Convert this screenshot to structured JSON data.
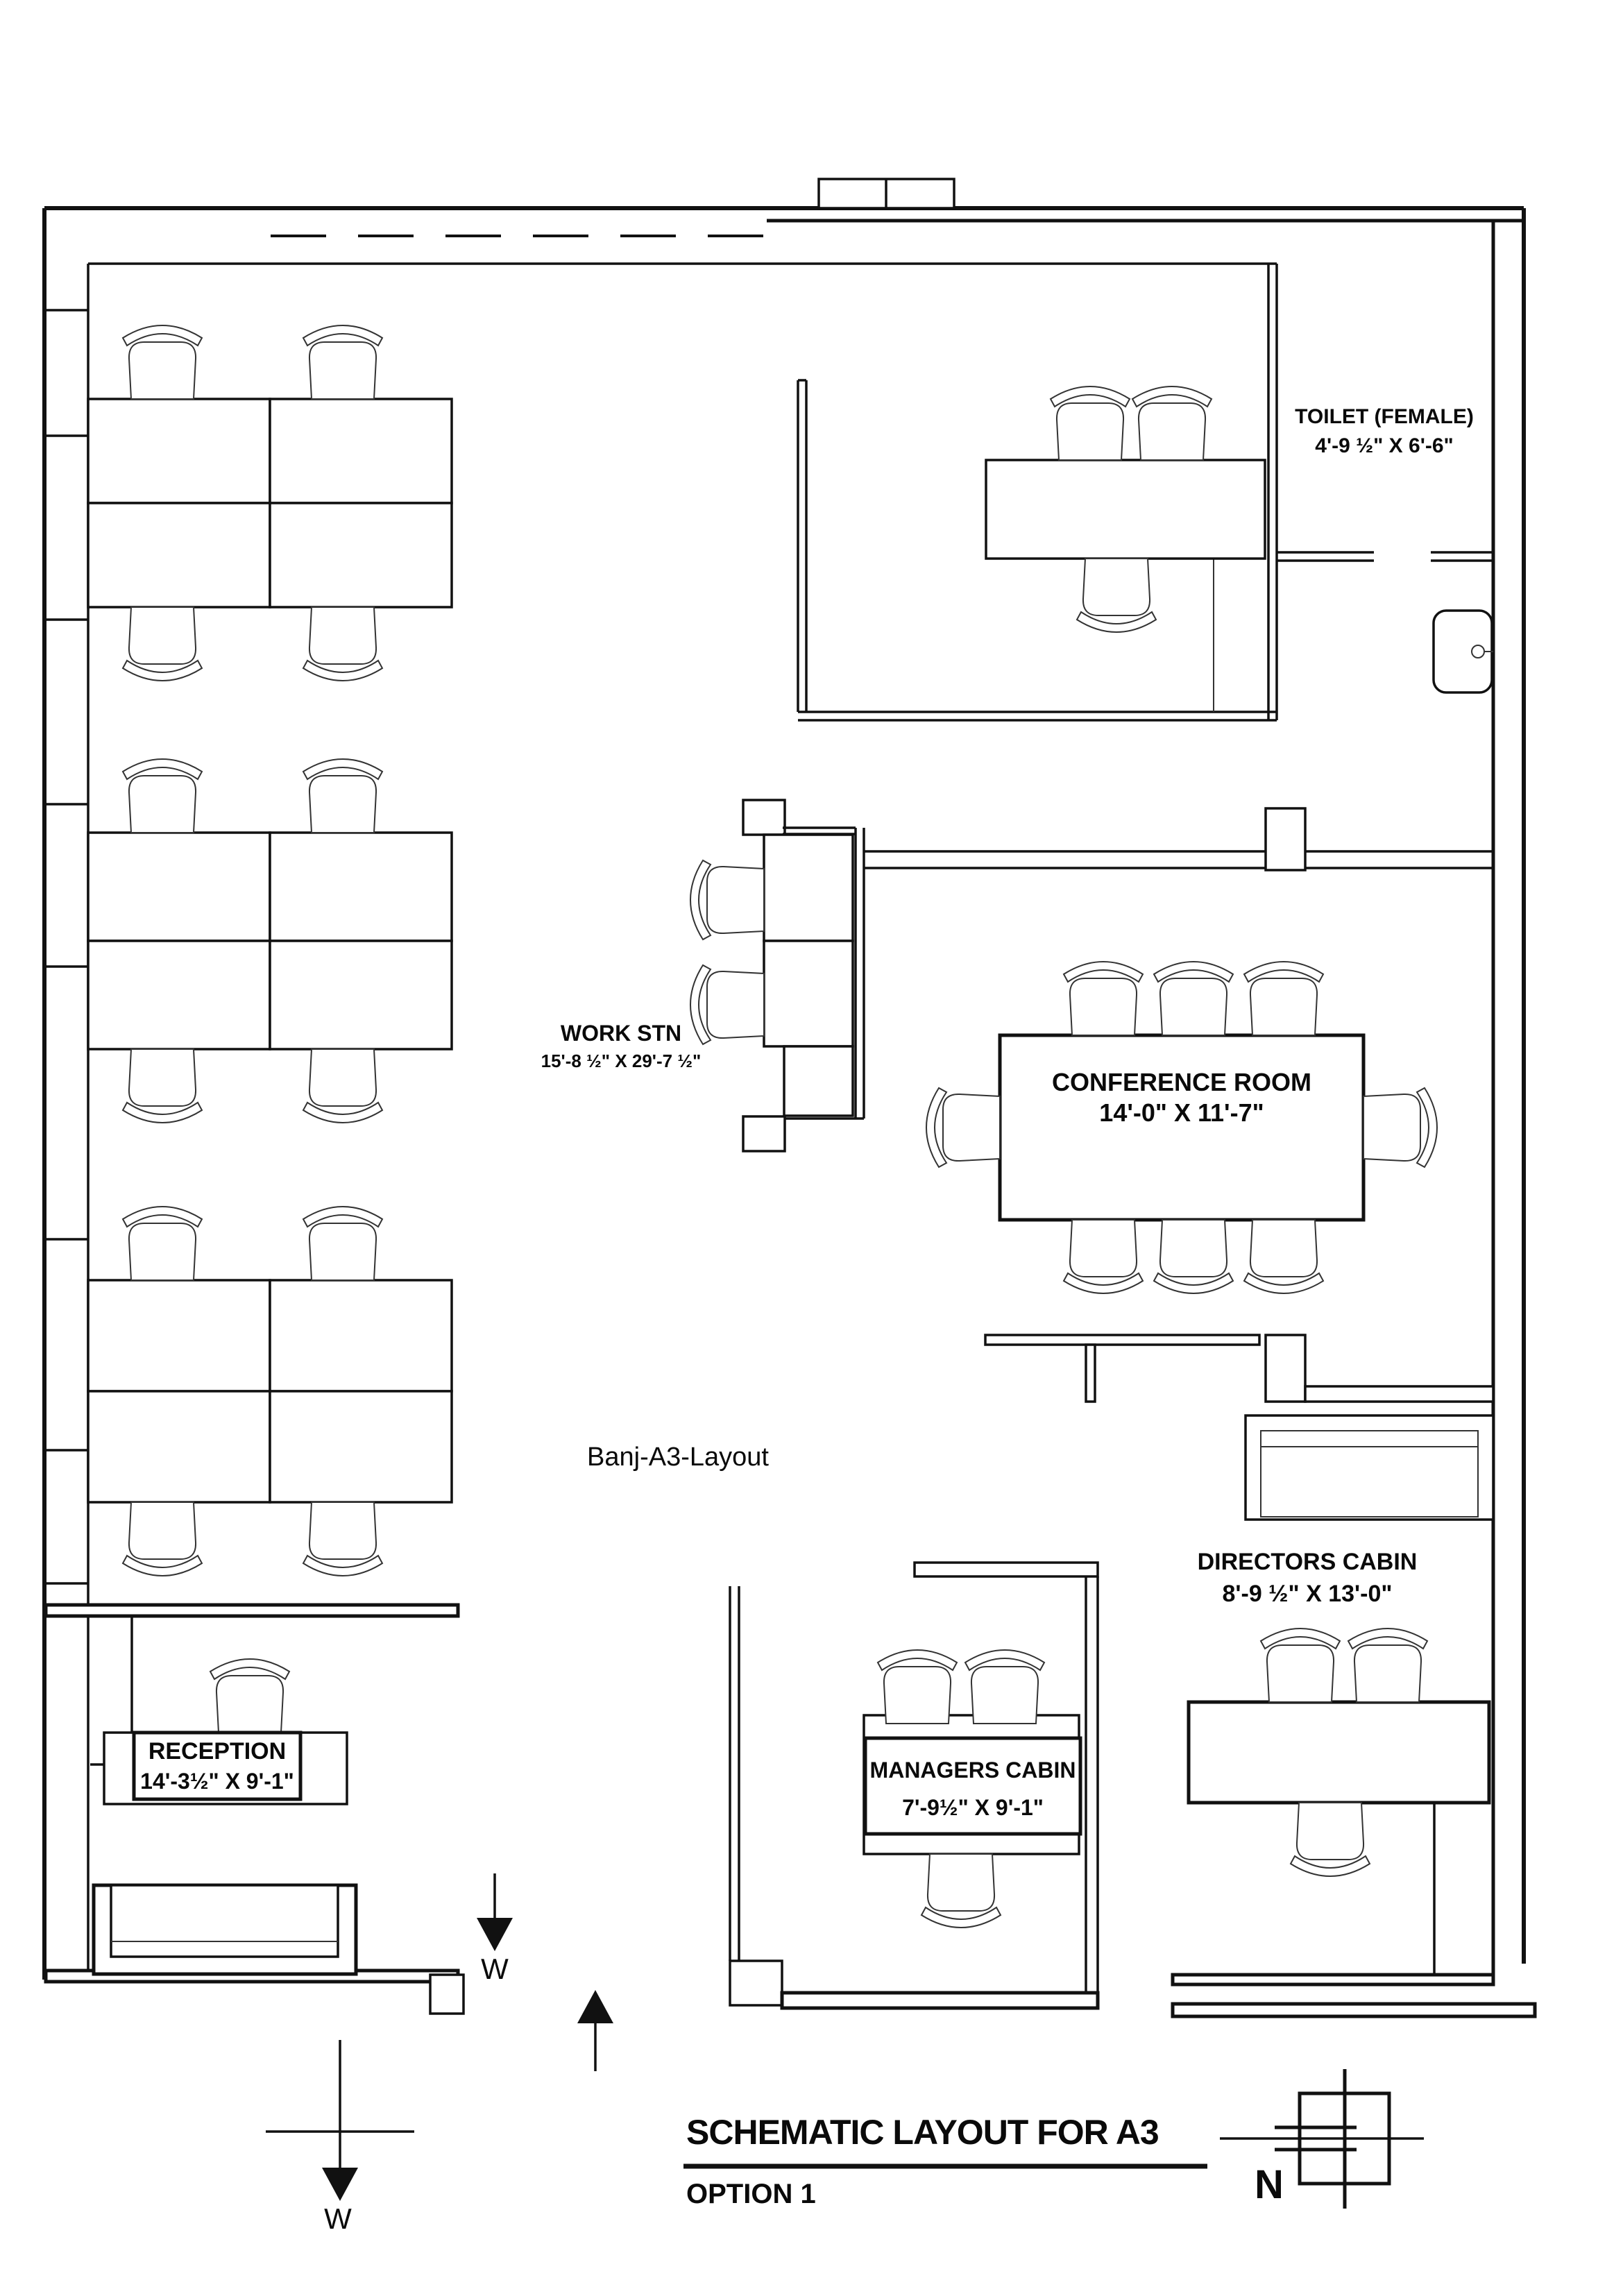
{
  "meta": {
    "background_color": "#ffffff",
    "line_color": "#111111",
    "drawing_type": "architectural schematic floor plan"
  },
  "rooms": {
    "toilet": {
      "name": "TOILET (FEMALE)",
      "dims": "4'-9 ½\" X 6'-6\""
    },
    "workstation": {
      "name": "WORK STN",
      "dims": "15'-8 ½\" X 29'-7 ½\""
    },
    "conference": {
      "name": "CONFERENCE ROOM",
      "dims": "14'-0\" X 11'-7\""
    },
    "directors": {
      "name": "DIRECTORS CABIN",
      "dims": "8'-9 ½\" X 13'-0\""
    },
    "managers": {
      "name": "MANAGERS CABIN",
      "dims": "7'-9½\" X 9'-1\""
    },
    "reception": {
      "name": "RECEPTION",
      "dims": "14'-3½\" X 9'-1\""
    }
  },
  "annotations": {
    "drawing_label": "Banj-A3-Layout",
    "entry_west_label": "W",
    "compass_west_label": "W",
    "north_label": "N"
  },
  "title_block": {
    "title": "SCHEMATIC LAYOUT FOR A3",
    "option": "OPTION 1"
  }
}
